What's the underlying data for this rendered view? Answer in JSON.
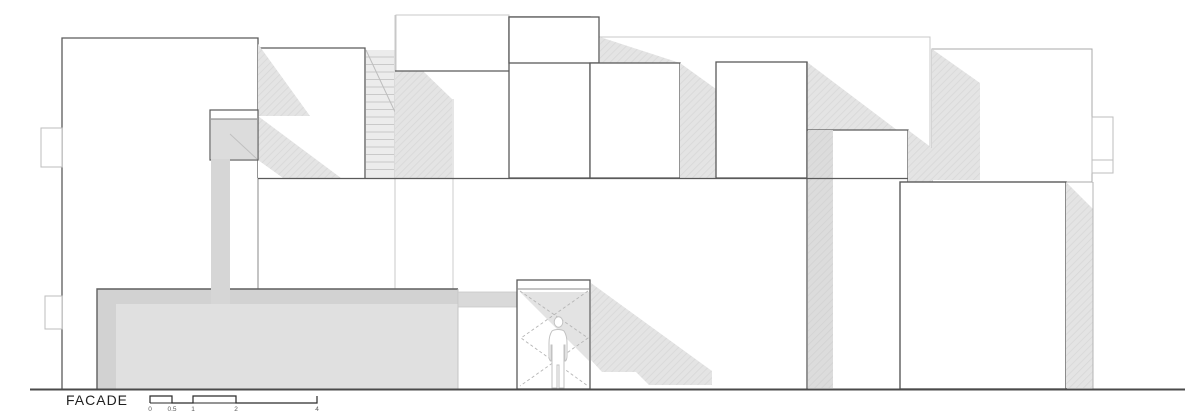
{
  "drawing": {
    "label": "FACADE",
    "type_note": "architectural facade elevation, white volumes with gray cast shadows",
    "ground_visible": true
  },
  "icons": {
    "human_figure": "person-silhouette",
    "stairs": "stair-tread-hatch"
  },
  "colors": {
    "background": "#ffffff",
    "line_dark": "#5a5a5a",
    "line_medium": "#9a9a9a",
    "line_light": "#c8c8c8",
    "shadow": "#e2e2e2",
    "shadow_dark": "#d9d9d9",
    "wall_outer": "#d2d2d2",
    "wall_inner": "#e0e0e0",
    "ground": "#4a4a4a"
  },
  "scalebar": {
    "units_note": "meters",
    "ticks": [
      {
        "label": "0"
      },
      {
        "label": "0.5"
      },
      {
        "label": "1"
      },
      {
        "label": "2"
      },
      {
        "label": "4"
      }
    ]
  }
}
